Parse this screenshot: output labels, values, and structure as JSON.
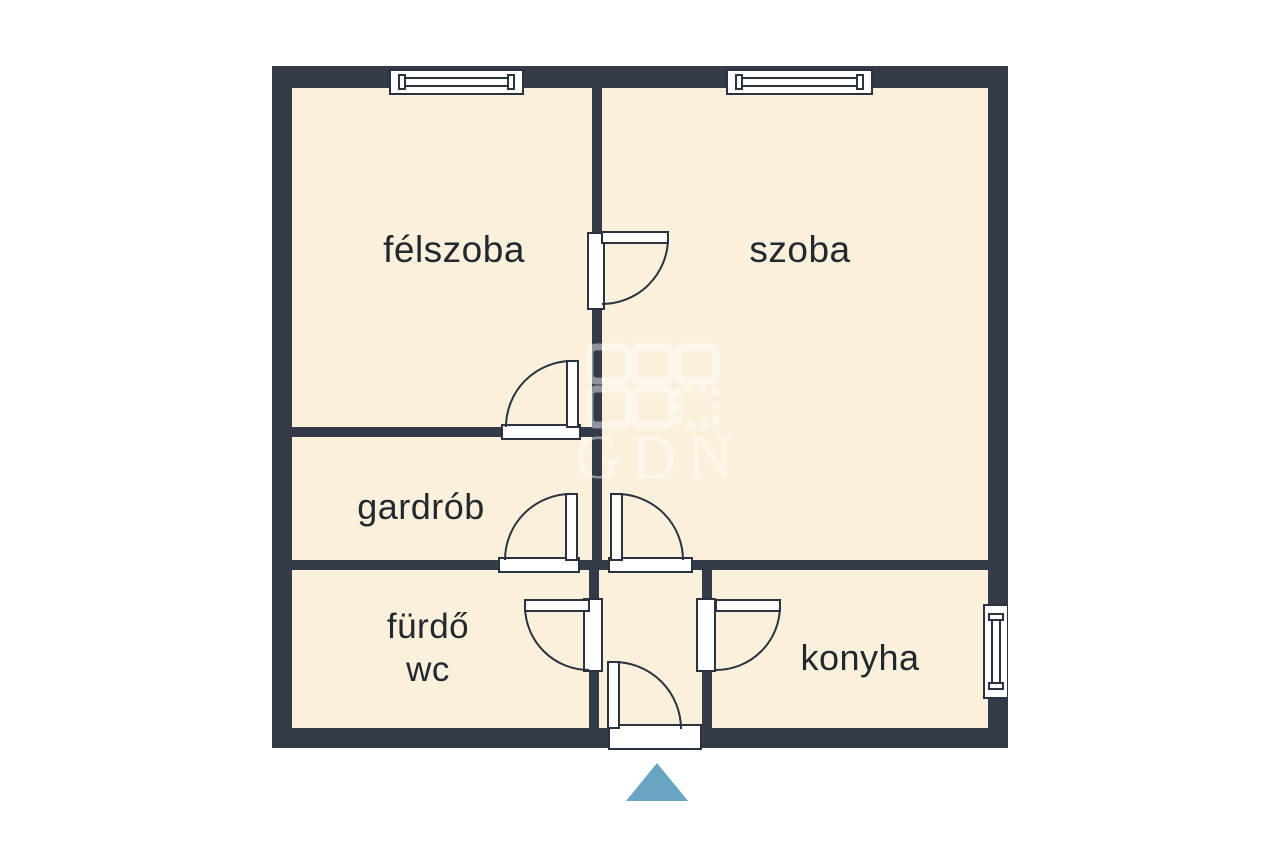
{
  "floorplan": {
    "rooms": {
      "felszoba": {
        "label": "félszoba"
      },
      "szoba": {
        "label": "szoba"
      },
      "gardrob": {
        "label": "gardrób"
      },
      "furdo_wc": {
        "line1": "fürdő",
        "line2": "wc"
      },
      "konyha": {
        "label": "konyha"
      }
    },
    "watermark": {
      "text": "GDN"
    },
    "colors": {
      "wall": "#333b48",
      "floor": "#faf0dc",
      "label": "#23272e",
      "door_window_fill": "#ffffff",
      "outline": "#2b3240",
      "entrance_marker": "#68a5c2",
      "background": "#ffffff"
    }
  }
}
